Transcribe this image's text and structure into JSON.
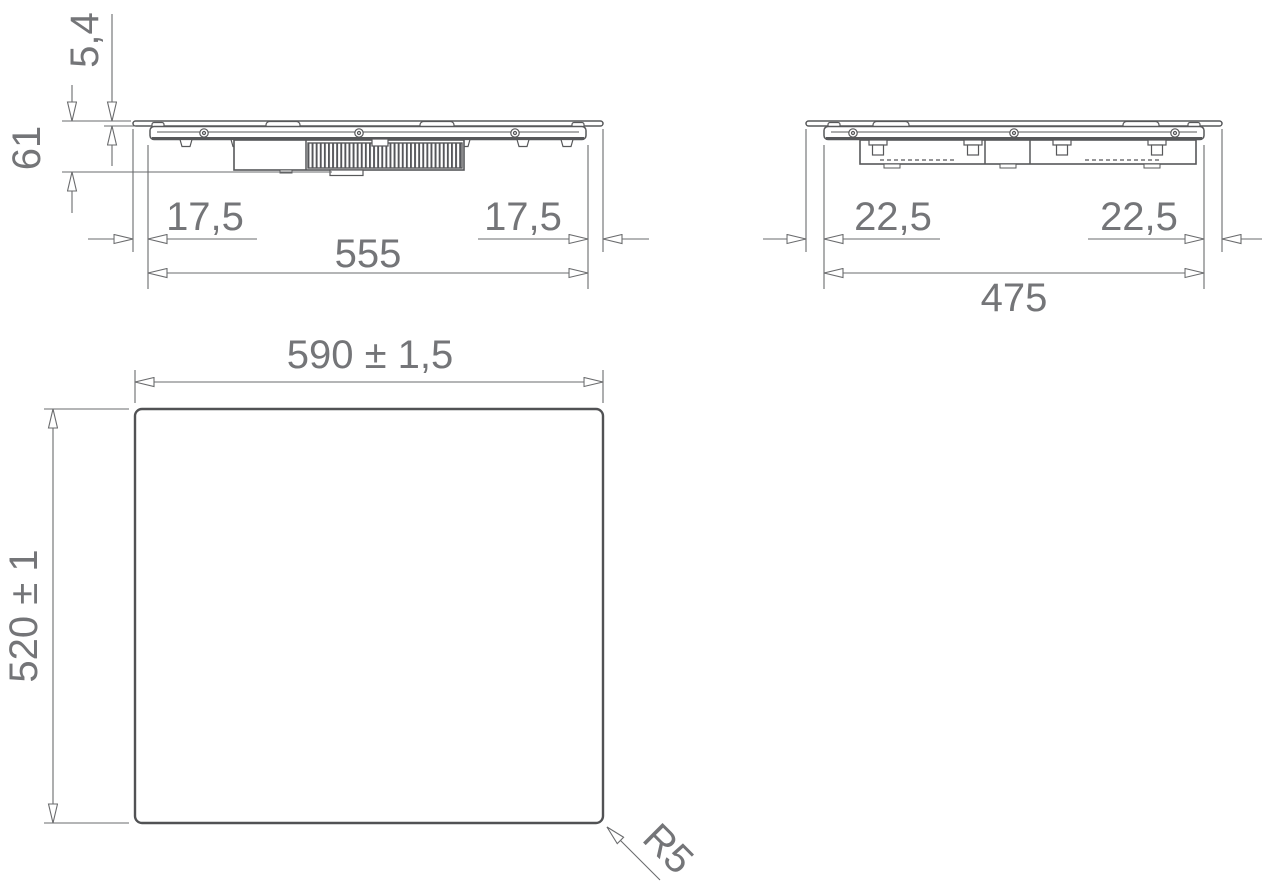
{
  "drawing": {
    "title": "hob installation dimension drawing",
    "colors": {
      "part_line": "#57585a",
      "dimension_line": "#6a6b6d",
      "text": "#747578"
    },
    "front_view": {
      "glass_thickness": "5,4",
      "total_height": "61",
      "left_overhang": "17,5",
      "right_overhang": "17,5",
      "body_width": "555"
    },
    "side_view": {
      "left_overhang": "22,5",
      "right_overhang": "22,5",
      "body_depth": "475"
    },
    "plan_view": {
      "cutout_width": "590 ± 1,5",
      "cutout_depth": "520 ± 1",
      "corner_radius": "R5"
    }
  }
}
